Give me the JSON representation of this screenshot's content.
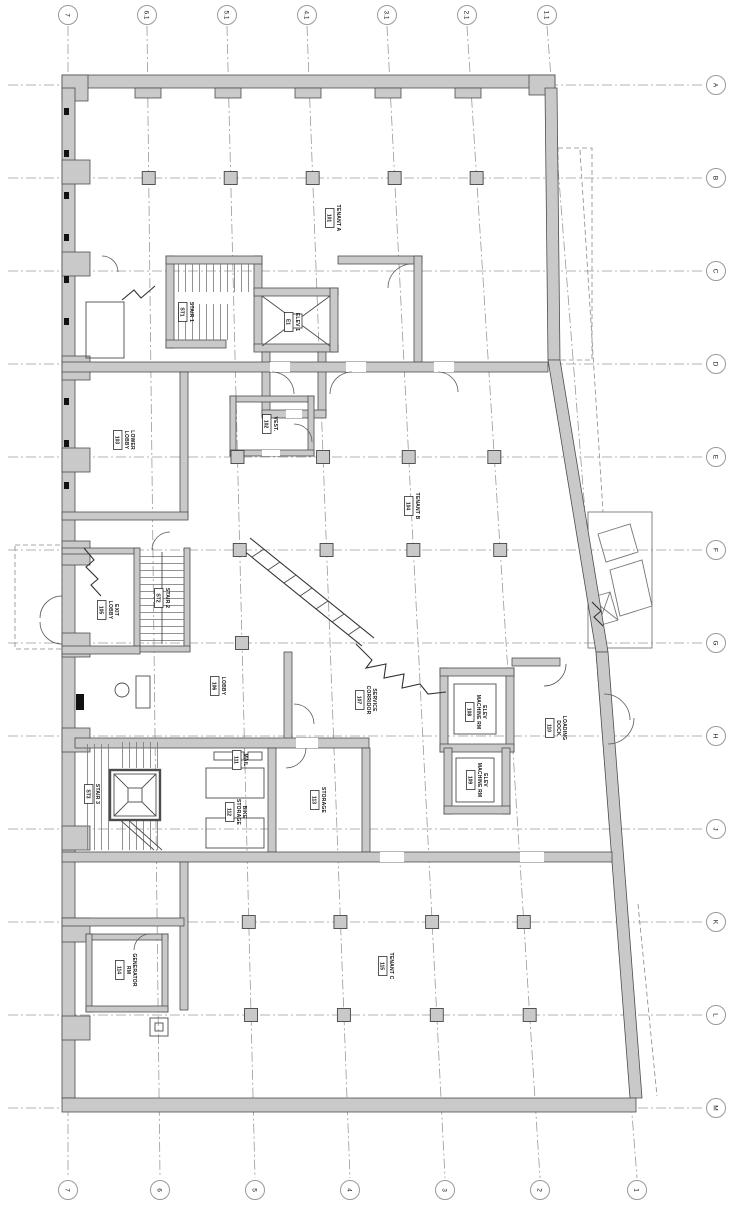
{
  "drawing": {
    "kind": "architectural floor plan (rotated sheet)",
    "background": "#ffffff",
    "wall_fill": "#c9c9c9",
    "wall_stroke": "#4d4d4d",
    "grid_color": "#9a9a9a",
    "text_color": "#111111"
  },
  "grid": {
    "top_bubbles": [
      {
        "label": "7",
        "x": 68
      },
      {
        "label": "6.1",
        "x": 147
      },
      {
        "label": "5.1",
        "x": 227
      },
      {
        "label": "4.1",
        "x": 307
      },
      {
        "label": "3.1",
        "x": 387
      },
      {
        "label": "2.1",
        "x": 467
      },
      {
        "label": "1.1",
        "x": 547
      }
    ],
    "bottom_bubbles": [
      {
        "label": "7",
        "x": 68
      },
      {
        "label": "6",
        "x": 160
      },
      {
        "label": "5",
        "x": 255
      },
      {
        "label": "4",
        "x": 350
      },
      {
        "label": "3",
        "x": 445
      },
      {
        "label": "2",
        "x": 540
      },
      {
        "label": "1",
        "x": 637
      }
    ],
    "right_bubbles": [
      {
        "label": "A",
        "y": 85
      },
      {
        "label": "B",
        "y": 178
      },
      {
        "label": "C",
        "y": 271
      },
      {
        "label": "D",
        "y": 364
      },
      {
        "label": "E",
        "y": 457
      },
      {
        "label": "F",
        "y": 550
      },
      {
        "label": "G",
        "y": 643
      },
      {
        "label": "H",
        "y": 736
      },
      {
        "label": "J",
        "y": 829
      },
      {
        "label": "K",
        "y": 922
      },
      {
        "label": "L",
        "y": 1015
      },
      {
        "label": "M",
        "y": 1108
      }
    ],
    "v_line_top_y": 26,
    "v_line_bottom_y": 1178,
    "h_line_left_x": 8,
    "h_line_right_x": 704,
    "bubble_radius": 9.5
  },
  "columns": {
    "size": 13,
    "rows": [
      {
        "y": 178,
        "cols": [
          1,
          2,
          3,
          4,
          5
        ]
      },
      {
        "y": 457,
        "cols": [
          2,
          3,
          4,
          5
        ]
      },
      {
        "y": 550,
        "cols": [
          2,
          3,
          4,
          5
        ]
      },
      {
        "y": 643,
        "cols": [
          2
        ]
      },
      {
        "y": 922,
        "cols": [
          2,
          3,
          4,
          5
        ]
      },
      {
        "y": 1015,
        "cols": [
          2,
          3,
          4,
          5
        ]
      }
    ]
  },
  "rooms": [
    {
      "lines": [
        "TENANT A"
      ],
      "number": "101",
      "x": 333,
      "y": 218
    },
    {
      "lines": [
        "STAIR 1"
      ],
      "number": "ST1",
      "x": 186,
      "y": 312
    },
    {
      "lines": [
        "ELEV 1"
      ],
      "number": "E1",
      "x": 292,
      "y": 322
    },
    {
      "lines": [
        "VEST."
      ],
      "number": "102",
      "x": 270,
      "y": 424
    },
    {
      "lines": [
        "LOWER",
        "LOBBY"
      ],
      "number": "103",
      "x": 124,
      "y": 440
    },
    {
      "lines": [
        "TENANT B"
      ],
      "number": "104",
      "x": 412,
      "y": 506
    },
    {
      "lines": [
        "EXIT",
        "LOBBY"
      ],
      "number": "105",
      "x": 108,
      "y": 610
    },
    {
      "lines": [
        "STAIR 2"
      ],
      "number": "ST2",
      "x": 162,
      "y": 598
    },
    {
      "lines": [
        "LOBBY"
      ],
      "number": "106",
      "x": 218,
      "y": 686
    },
    {
      "lines": [
        "SERVICE",
        "CORRIDOR"
      ],
      "number": "107",
      "x": 366,
      "y": 700
    },
    {
      "lines": [
        "ELEV",
        "MACHINE RM"
      ],
      "number": "108",
      "x": 476,
      "y": 712
    },
    {
      "lines": [
        "ELEV",
        "MACHINE RM"
      ],
      "number": "109",
      "x": 477,
      "y": 780
    },
    {
      "lines": [
        "LOADING",
        "DOCK"
      ],
      "number": "110",
      "x": 556,
      "y": 728
    },
    {
      "lines": [
        "STAIR 3"
      ],
      "number": "ST3",
      "x": 92,
      "y": 794
    },
    {
      "lines": [
        "MAIL"
      ],
      "number": "111",
      "x": 240,
      "y": 760
    },
    {
      "lines": [
        "BIKE",
        "STORAGE"
      ],
      "number": "112",
      "x": 236,
      "y": 812
    },
    {
      "lines": [
        "STORAGE"
      ],
      "number": "113",
      "x": 318,
      "y": 800
    },
    {
      "lines": [
        "GENERATOR",
        "RM"
      ],
      "number": "114",
      "x": 126,
      "y": 970
    },
    {
      "lines": [
        "TENANT C"
      ],
      "number": "115",
      "x": 386,
      "y": 966
    }
  ]
}
